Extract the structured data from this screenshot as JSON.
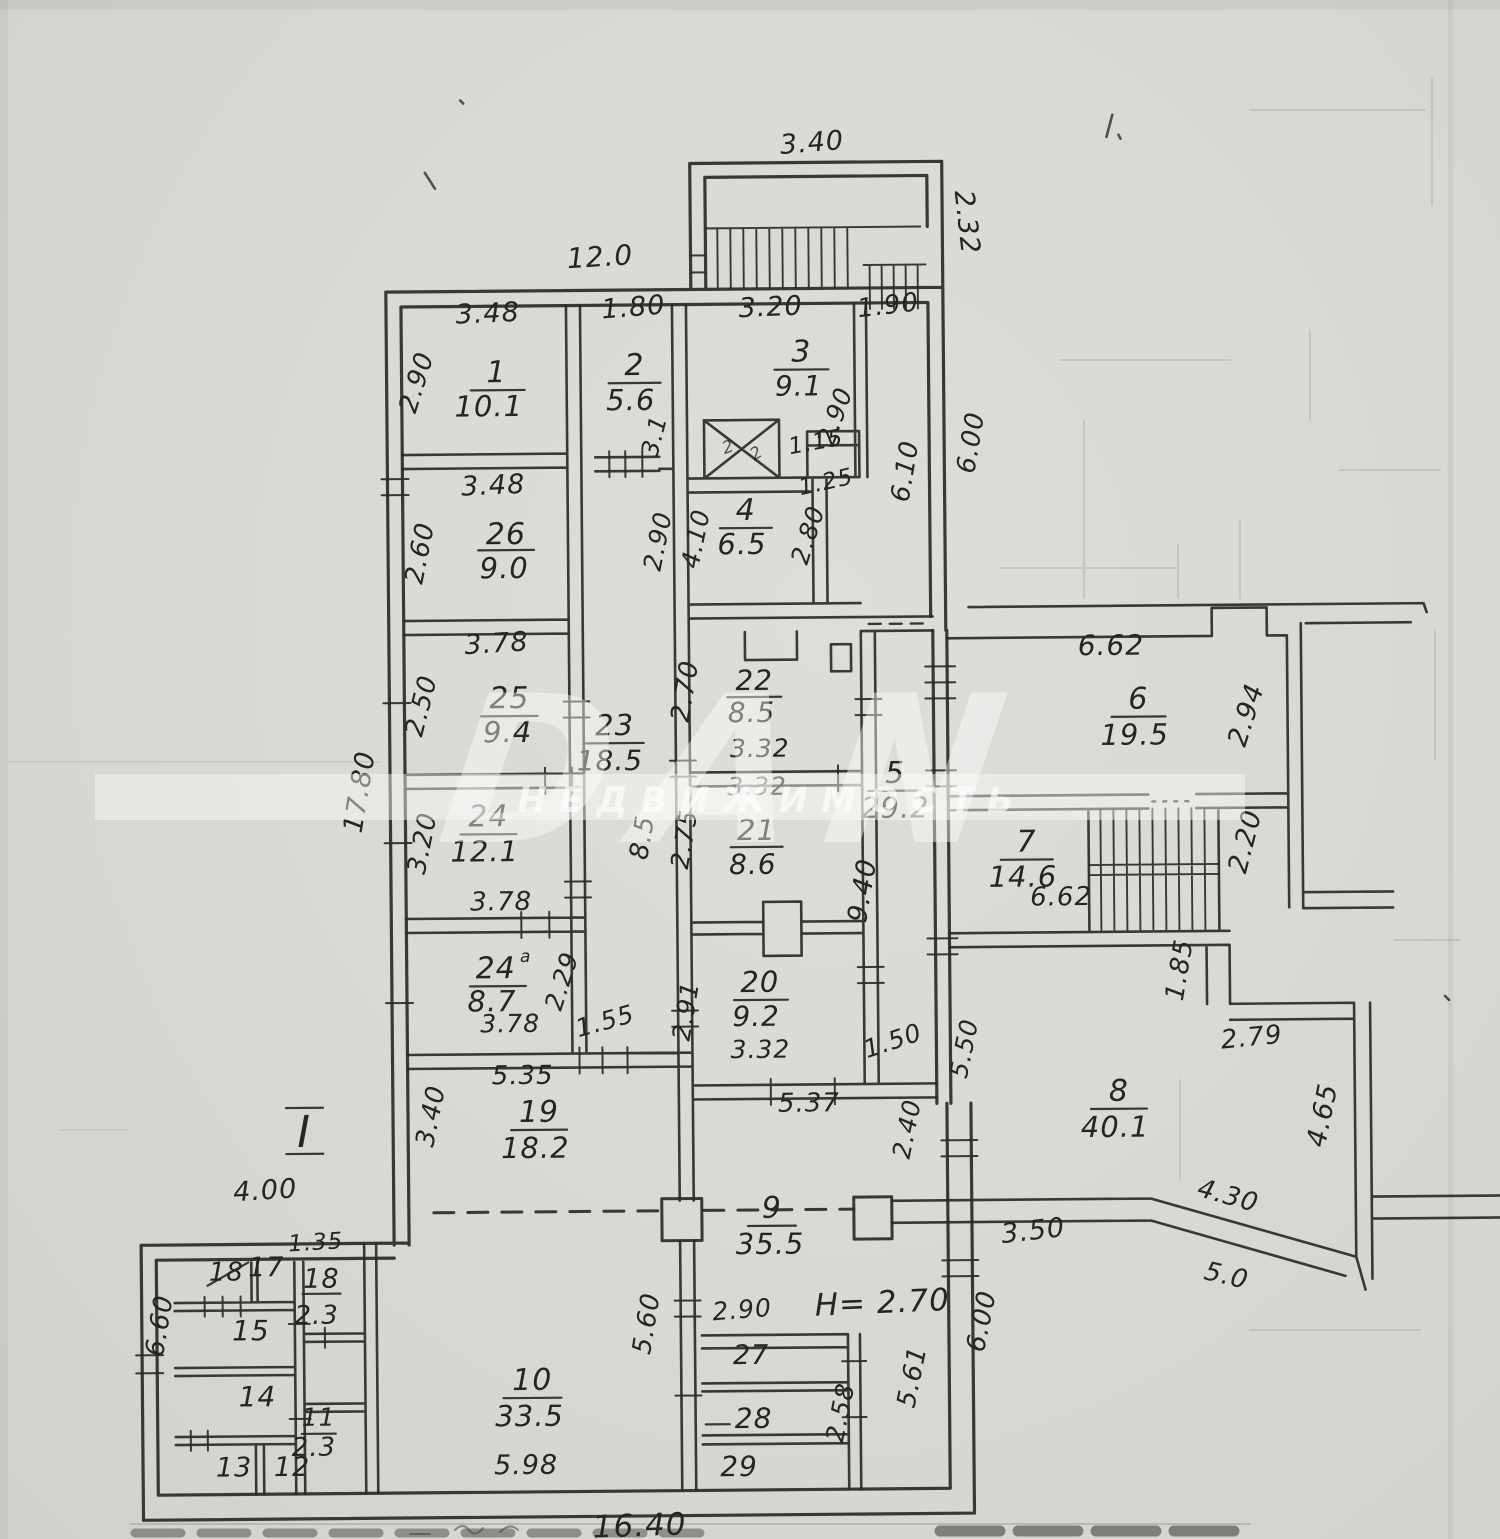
{
  "watermark": {
    "brand": "DAN",
    "subtitle": "НЕДВИЖИМОСТЬ"
  },
  "notes": {
    "height_note": "H= 2.70",
    "section_mark": "I",
    "bottom_dim": "16.40",
    "lift_mark_a": "2",
    "lift_mark_b": "2"
  },
  "rooms": {
    "r1": {
      "num": "1",
      "area": "10.1"
    },
    "r2": {
      "num": "2",
      "area": "5.6"
    },
    "r3": {
      "num": "3",
      "area": "9.1"
    },
    "r4": {
      "num": "4",
      "area": "6.5"
    },
    "r5": {
      "num": "5",
      "area": "29.2"
    },
    "r6": {
      "num": "6",
      "area": "19.5"
    },
    "r7": {
      "num": "7",
      "area": "14.6"
    },
    "r8": {
      "num": "8",
      "area": "40.1"
    },
    "r9": {
      "num": "9",
      "area": "35.5"
    },
    "r10": {
      "num": "10",
      "area": "33.5"
    },
    "r11": {
      "num": "11",
      "area": "2.3"
    },
    "r12": {
      "num": "12"
    },
    "r13": {
      "num": "13"
    },
    "r14": {
      "num": "14"
    },
    "r15": {
      "num": "15"
    },
    "r17": {
      "num": "17"
    },
    "r18x": {
      "num": "18"
    },
    "r18": {
      "num": "18",
      "area": "2.3"
    },
    "r19": {
      "num": "19",
      "area": "18.2"
    },
    "r20": {
      "num": "20",
      "area": "9.2"
    },
    "r21": {
      "num": "21",
      "area": "8.6"
    },
    "r22": {
      "num": "22",
      "area": "8.5"
    },
    "r23": {
      "num": "23",
      "area": "18.5"
    },
    "r24": {
      "num": "24",
      "area": "12.1"
    },
    "r24a": {
      "num": "24",
      "sup": "a",
      "area": "8.7"
    },
    "r25": {
      "num": "25",
      "area": "9.4"
    },
    "r26": {
      "num": "26",
      "area": "9.0"
    },
    "r27": {
      "num": "27"
    },
    "r28": {
      "num": "28"
    },
    "r29": {
      "num": "29"
    }
  },
  "dims": {
    "d340t": "3.40",
    "d232": "2.32",
    "d120": "12.0",
    "d190": "1.90",
    "d348a": "3.48",
    "d180": "1.80",
    "d320r3": "3.20",
    "d290r1": "2.90",
    "d31": "3.1",
    "d115": "1.15",
    "d125": "1.25",
    "d290r3": "2.90",
    "d410": "4.10",
    "d290c": "2.90",
    "d280": "2.80",
    "d610": "6.10",
    "d600t": "6.00",
    "d348b": "3.48",
    "d260": "2.60",
    "d378a": "3.78",
    "d250": "2.50",
    "d85v": "8.5",
    "d270": "2.70",
    "d332a": "3.32",
    "d332b": "3.32",
    "d940": "9.40",
    "d275": "2.75",
    "d291": "2.91",
    "d332c": "3.32",
    "d150": "1.50",
    "d320l": "3.20",
    "d378b": "3.78",
    "d378c": "3.78",
    "d229": "2.29",
    "d155": "1.55",
    "d1780": "17.80",
    "d535": "5.35",
    "d340l": "3.40",
    "d537": "5.37",
    "d240": "2.40",
    "d550": "5.50",
    "d662a": "6.62",
    "d294": "2.94",
    "d662b": "6.62",
    "d220": "2.20",
    "d185": "1.85",
    "d279": "2.79",
    "d465": "4.65",
    "d430": "4.30",
    "d50": "5.0",
    "d350": "3.50",
    "d600b": "6.00",
    "d561": "5.61",
    "d560": "5.60",
    "d290b": "2.90",
    "d258": "2.58",
    "d598": "5.98",
    "d400": "4.00",
    "d135": "1.35",
    "d660": "6.60"
  }
}
